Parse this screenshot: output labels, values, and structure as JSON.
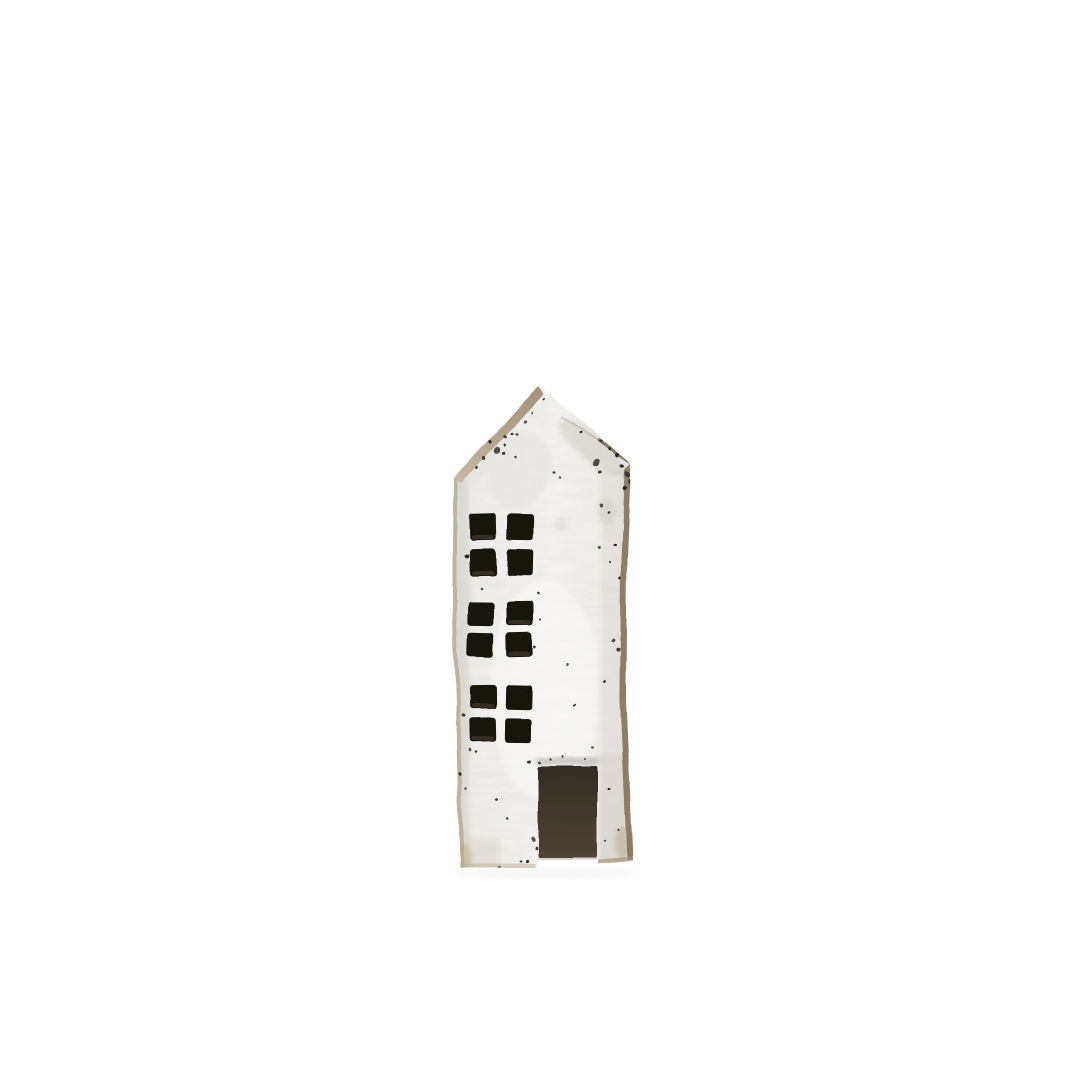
{
  "scene": {
    "description": "Handmade rustic white-washed wooden house figurine with a pointed gable roof, three 2x2 cut-out windows and a dark rectangular doorway, photographed on a plain white background",
    "background_color": "#ffffff"
  },
  "house": {
    "colors": {
      "paint": "#f3f2ef",
      "paint_bright": "#f8f7f5",
      "paint_shadow_left": "#e6e4df",
      "paint_shadow_right": "#e3e1db",
      "wood_edge": "#b1a38c",
      "wood_edge_light": "#c6baa6",
      "wood_edge_dark": "#7d6c53",
      "window": "#16120e",
      "window_lip": "#4e4334",
      "door_top": "#332d26",
      "door_bottom": "#4d4335",
      "distress": "#1d1a16",
      "shadow": "#9a9a96"
    },
    "outline": [
      [
        538,
        386
      ],
      [
        631,
        463
      ],
      [
        627,
        560
      ],
      [
        626,
        700
      ],
      [
        630,
        790
      ],
      [
        633,
        861
      ],
      [
        598,
        864
      ],
      [
        597,
        860
      ],
      [
        538,
        860
      ],
      [
        535,
        868
      ],
      [
        460,
        868
      ],
      [
        457,
        760
      ],
      [
        453,
        620
      ],
      [
        453,
        540
      ],
      [
        454,
        478
      ]
    ],
    "strips": [
      {
        "name": "roof-edge",
        "points": [
          [
            538,
            386
          ],
          [
            454,
            478
          ],
          [
            462,
            483
          ],
          [
            543,
            394
          ]
        ],
        "fill": "roofGrad",
        "opacity": 1
      },
      {
        "name": "left-edge",
        "points": [
          [
            454,
            478
          ],
          [
            453,
            540
          ],
          [
            453,
            620
          ],
          [
            457,
            760
          ],
          [
            460,
            868
          ],
          [
            464,
            868
          ],
          [
            461,
            760
          ],
          [
            457,
            620
          ],
          [
            457,
            540
          ],
          [
            458,
            480
          ]
        ],
        "fill": "#b1a38c",
        "opacity": 0.7
      },
      {
        "name": "right-edge",
        "points": [
          [
            631,
            463
          ],
          [
            627,
            560
          ],
          [
            626,
            700
          ],
          [
            630,
            790
          ],
          [
            633,
            861
          ],
          [
            627,
            861
          ],
          [
            624,
            790
          ],
          [
            620,
            700
          ],
          [
            621,
            560
          ],
          [
            625,
            470
          ]
        ],
        "fill": "#7d6c53",
        "opacity": 0.85
      },
      {
        "name": "bottom-edge-left",
        "points": [
          [
            460,
            868
          ],
          [
            535,
            868
          ],
          [
            535,
            864
          ],
          [
            460,
            864
          ]
        ],
        "fill": "#b9ab92",
        "opacity": 0.5
      },
      {
        "name": "bottom-edge-door",
        "points": [
          [
            538,
            860
          ],
          [
            597,
            860
          ],
          [
            597,
            857
          ],
          [
            538,
            857
          ]
        ],
        "fill": "#b9ab92",
        "opacity": 0.4
      },
      {
        "name": "bottom-edge-right",
        "points": [
          [
            598,
            864
          ],
          [
            633,
            861
          ],
          [
            633,
            857
          ],
          [
            598,
            860
          ]
        ],
        "fill": "#a08e72",
        "opacity": 0.65
      }
    ],
    "edge_lines": [
      {
        "x1": 598,
        "y1": 440,
        "x2": 629,
        "y2": 461,
        "color": "#6f604c",
        "width": 3.5,
        "opacity": 0.8
      },
      {
        "x1": 560,
        "y1": 417,
        "x2": 597,
        "y2": 440,
        "color": "#b3ab9d",
        "width": 2,
        "opacity": 0.5
      }
    ],
    "shading": [
      {
        "shape": "rect",
        "x": 455,
        "y": 478,
        "w": 14,
        "h": 392,
        "fill": "#cdcac3",
        "opacity": 0.45
      },
      {
        "shape": "rect",
        "x": 601,
        "y": 470,
        "w": 25,
        "h": 390,
        "fill": "#d6d3cc",
        "opacity": 0.4
      },
      {
        "shape": "ellipse",
        "cx": 592,
        "cy": 448,
        "rx": 42,
        "ry": 13,
        "rot": 38,
        "fill": "#c2beb5",
        "opacity": 0.4
      },
      {
        "shape": "ellipse",
        "cx": 472,
        "cy": 436,
        "rx": 26,
        "ry": 46,
        "rot": 0,
        "fill": "#d9d6d0",
        "opacity": 0.35
      },
      {
        "shape": "ellipse",
        "cx": 520,
        "cy": 470,
        "rx": 30,
        "ry": 40,
        "rot": 20,
        "fill": "#e4e2dd",
        "opacity": 0.5
      },
      {
        "shape": "rect",
        "x": 598,
        "y": 755,
        "w": 29,
        "h": 106,
        "fill": "#d2cfc8",
        "opacity": 0.45
      },
      {
        "shape": "ellipse",
        "cx": 606,
        "cy": 512,
        "rx": 9,
        "ry": 13,
        "rot": 0,
        "fill": "#d0ccc4",
        "opacity": 0.6
      },
      {
        "shape": "ellipse",
        "cx": 560,
        "cy": 523,
        "rx": 8,
        "ry": 6,
        "rot": 0,
        "fill": "#d8d5cf",
        "opacity": 0.5
      },
      {
        "shape": "ellipse",
        "cx": 545,
        "cy": 690,
        "rx": 55,
        "ry": 110,
        "rot": 0,
        "fill": "#fafaf8",
        "opacity": 0.5
      },
      {
        "shape": "rect",
        "x": 458,
        "y": 838,
        "w": 42,
        "h": 32,
        "fill": "#cfc8ba",
        "opacity": 0.35
      },
      {
        "shape": "ellipse",
        "cx": 463,
        "cy": 858,
        "rx": 9,
        "ry": 13,
        "rot": 0,
        "fill": "#b3a284",
        "opacity": 0.4
      },
      {
        "shape": "ellipse",
        "cx": 622,
        "cy": 843,
        "rx": 8,
        "ry": 17,
        "rot": 0,
        "fill": "#ab9a7e",
        "opacity": 0.4
      }
    ],
    "windows": [
      {
        "x": 470,
        "y": 513,
        "pane_w": 26,
        "pane_h": 27,
        "col_step": 37,
        "row_step": 36
      },
      {
        "x": 468,
        "y": 602,
        "pane_w": 26,
        "pane_h": 24,
        "col_step": 39,
        "row_step": 31
      },
      {
        "x": 469,
        "y": 685,
        "pane_w": 27,
        "pane_h": 24,
        "col_step": 36,
        "row_step": 33
      }
    ],
    "door": {
      "x": 538,
      "y": 766,
      "width": 59,
      "height": 92
    },
    "lintel": {
      "x": 537,
      "y": 757,
      "width": 61,
      "height": 8
    },
    "specks": [
      [
        497,
        427,
        3
      ],
      [
        505,
        436,
        2
      ],
      [
        490,
        442,
        2
      ],
      [
        497,
        451,
        4
      ],
      [
        504,
        454,
        2
      ],
      [
        512,
        433,
        1.5
      ],
      [
        517,
        457,
        1.5
      ],
      [
        484,
        459,
        2
      ],
      [
        477,
        468,
        1.5
      ],
      [
        525,
        421,
        1.8
      ],
      [
        517,
        433,
        1.6
      ],
      [
        505,
        445,
        1.6
      ],
      [
        532,
        412,
        1.4
      ],
      [
        543,
        399,
        1.2
      ],
      [
        580,
        433,
        1.5
      ],
      [
        600,
        441,
        1.8
      ],
      [
        610,
        449,
        2
      ],
      [
        618,
        455,
        2.5
      ],
      [
        597,
        463,
        4
      ],
      [
        601,
        472,
        1.8
      ],
      [
        623,
        466,
        2
      ],
      [
        628,
        474,
        3
      ],
      [
        631,
        481,
        3
      ],
      [
        625,
        487,
        2
      ],
      [
        632,
        493,
        2
      ],
      [
        555,
        473,
        1.5
      ],
      [
        561,
        478,
        1.2
      ],
      [
        601,
        506,
        2
      ],
      [
        608,
        513,
        1.5
      ],
      [
        615,
        545,
        1.5
      ],
      [
        599,
        547,
        1.8
      ],
      [
        610,
        562,
        1.2
      ],
      [
        620,
        578,
        1.6
      ],
      [
        613,
        641,
        2
      ],
      [
        618,
        650,
        2.2
      ],
      [
        629,
        645,
        3
      ],
      [
        631,
        658,
        2.5
      ],
      [
        628,
        671,
        2
      ],
      [
        605,
        682,
        1.5
      ],
      [
        593,
        748,
        1.5
      ],
      [
        538,
        594,
        1.5
      ],
      [
        540,
        620,
        1.2
      ],
      [
        567,
        665,
        1.5
      ],
      [
        574,
        706,
        1.5
      ],
      [
        467,
        556,
        2.5
      ],
      [
        481,
        589,
        1.5
      ],
      [
        529,
        641,
        2
      ],
      [
        535,
        647,
        1.5
      ],
      [
        521,
        692,
        2
      ],
      [
        463,
        716,
        2
      ],
      [
        519,
        738,
        2.5
      ],
      [
        470,
        750,
        1.8
      ],
      [
        476,
        752,
        1.4
      ],
      [
        530,
        761,
        2
      ],
      [
        540,
        762,
        1.6
      ],
      [
        551,
        759,
        1.3
      ],
      [
        563,
        757,
        1.2
      ],
      [
        585,
        759,
        1.1
      ],
      [
        497,
        800,
        1.6
      ],
      [
        508,
        818,
        1.5
      ],
      [
        533,
        840,
        2.5
      ],
      [
        536,
        849,
        1.8
      ],
      [
        527,
        862,
        1.8
      ],
      [
        549,
        863,
        1.5
      ],
      [
        520,
        862,
        1.4
      ],
      [
        460,
        775,
        1.8
      ],
      [
        466,
        790,
        1.4
      ],
      [
        499,
        868,
        1.5
      ],
      [
        609,
        789,
        1.5
      ],
      [
        605,
        841,
        1.4
      ],
      [
        618,
        830,
        1.2
      ]
    ],
    "cast_shadow": {
      "cx": 545,
      "cy": 873,
      "rx": 92,
      "ry": 6,
      "opacity": 0.08
    }
  }
}
